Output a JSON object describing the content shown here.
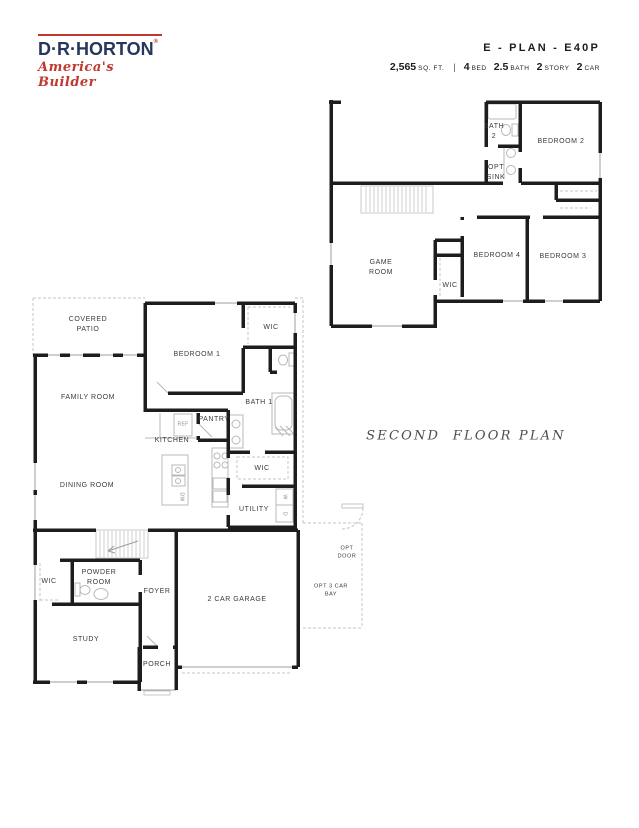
{
  "header": {
    "logo": {
      "name": "D·R·HORTON",
      "registered": "®",
      "tagline": "America's Builder"
    },
    "plan_title": "E - PLAN - E40P",
    "sqft": {
      "value": "2,565",
      "unit": "SQ. FT."
    },
    "separator": "|",
    "specs": [
      {
        "value": "4",
        "label": "BED"
      },
      {
        "value": "2.5",
        "label": "BATH"
      },
      {
        "value": "2",
        "label": "STORY"
      },
      {
        "value": "2",
        "label": "CAR"
      }
    ]
  },
  "second_floor": {
    "caption": "SECOND  FLOOR PLAN",
    "rooms": {
      "bath2": "BATH\n2",
      "opt_sink": "OPT\nSINK",
      "bedroom2": "BEDROOM 2",
      "game_room": "GAME\nROOM",
      "wic": "WIC",
      "bedroom4": "BEDROOM 4",
      "bedroom3": "BEDROOM 3"
    }
  },
  "first_floor": {
    "rooms": {
      "covered_patio": "COVERED\nPATIO",
      "bedroom1": "BEDROOM 1",
      "wic_bedroom1": "WIC",
      "family_room": "FAMILY ROOM",
      "bath1": "BATH 1",
      "pantry": "PANTRY",
      "kitchen": "KITCHEN",
      "dining_room": "DINING ROOM",
      "wic_master": "WIC",
      "utility": "UTILITY",
      "powder_room": "POWDER\nROOM",
      "wic_hall": "WIC",
      "foyer": "FOYER",
      "study": "STUDY",
      "porch": "PORCH",
      "garage": "2 CAR GARAGE",
      "opt_door": "OPT\nDOOR",
      "opt_3car_bay": "OPT 3 CAR\nBAY"
    },
    "appliances": {
      "ref": "REF",
      "dw": "DW",
      "washer": "W",
      "dryer": "D"
    }
  }
}
